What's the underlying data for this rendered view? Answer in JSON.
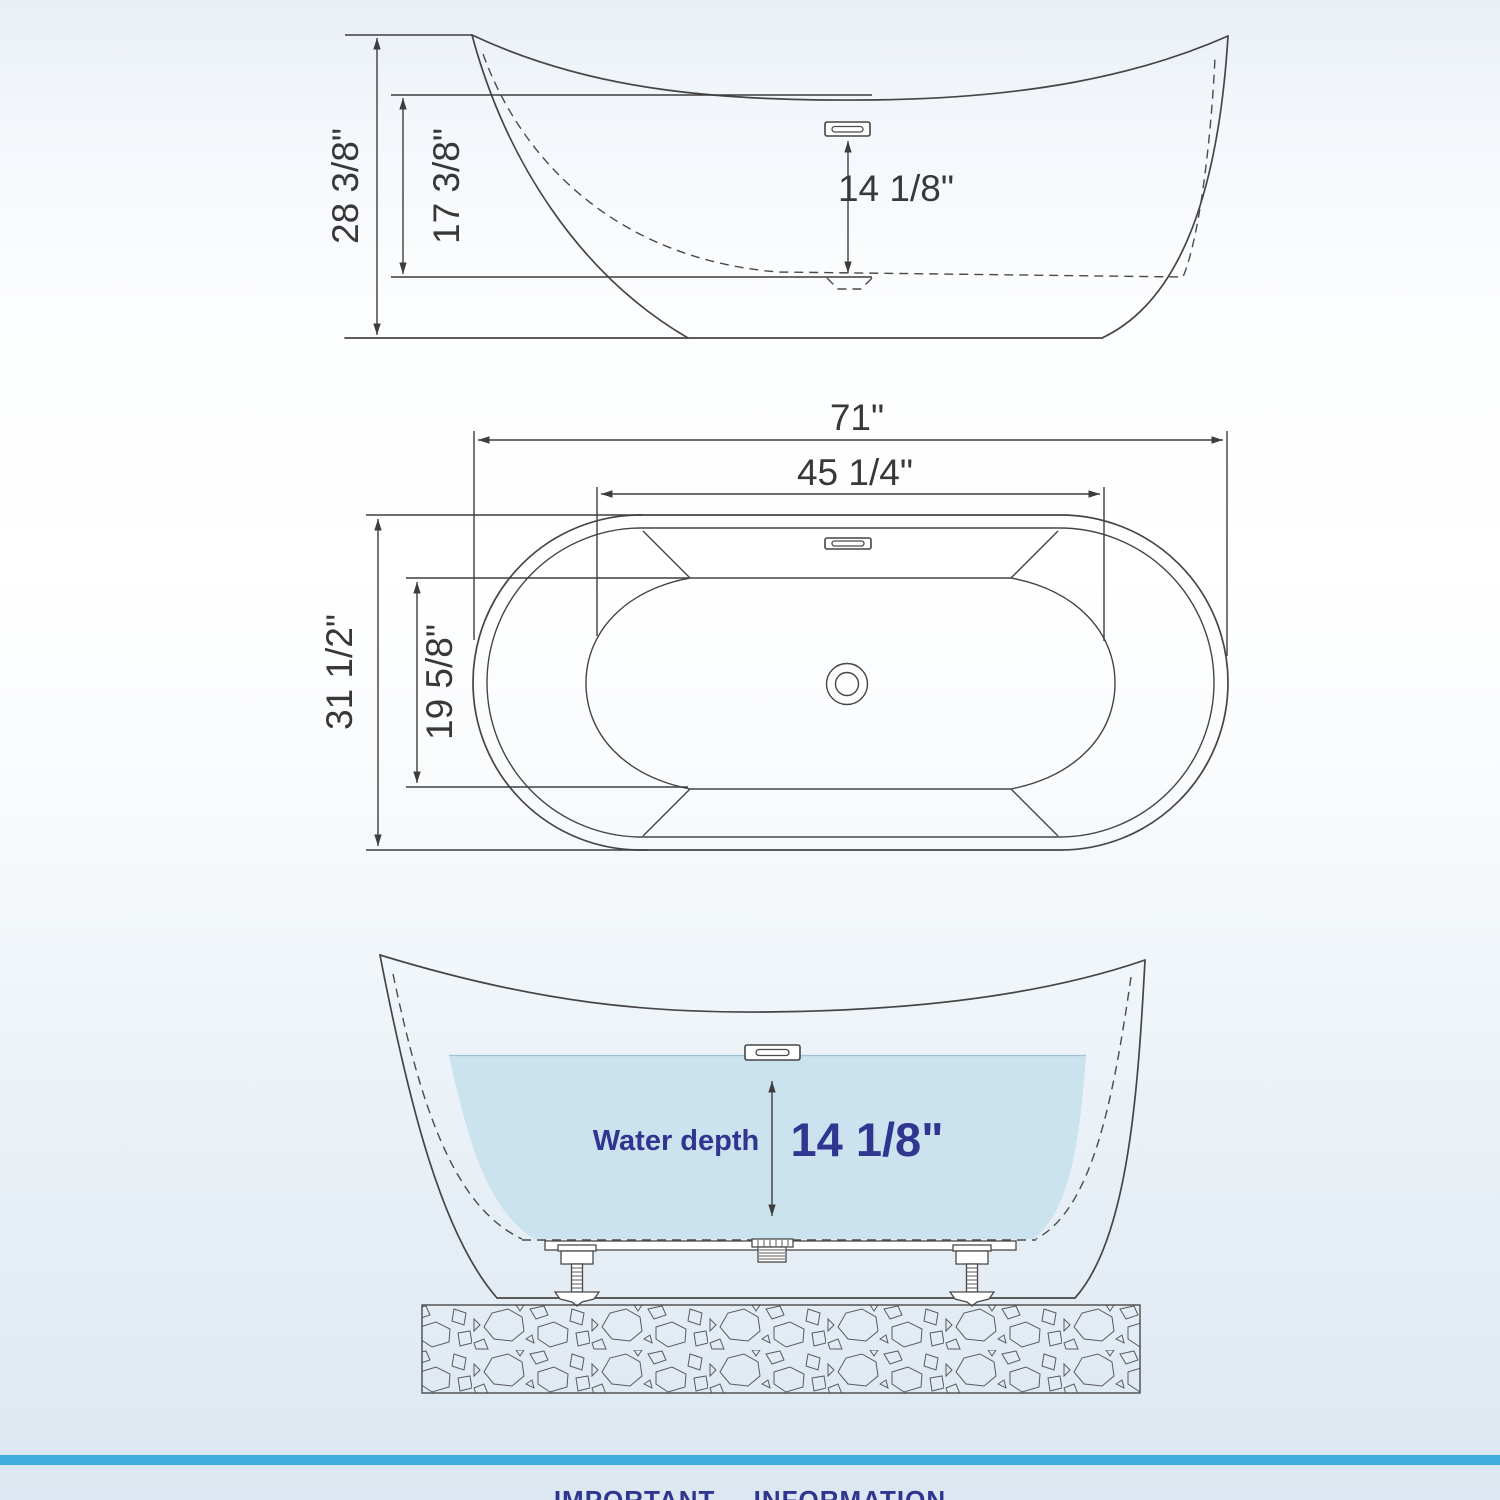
{
  "side_view": {
    "overall_height": "28 3/8\"",
    "rim_to_bottom_height": "17 3/8\"",
    "overflow_to_bottom": "14 1/8\""
  },
  "top_view": {
    "overall_length": "71\"",
    "basin_length": "45 1/4\"",
    "overall_width": "31 1/2\"",
    "basin_width": "19 5/8\""
  },
  "section_view": {
    "water_depth_label": "Water depth",
    "water_depth_value": "14 1/8\""
  },
  "footer": {
    "notice_title": "IMPORTANT INFORMATION"
  },
  "colors": {
    "annotation_navy": "#2f3690",
    "water_fill": "#cbe2ef",
    "accent_bar": "#3fadde",
    "line": "#454545"
  }
}
